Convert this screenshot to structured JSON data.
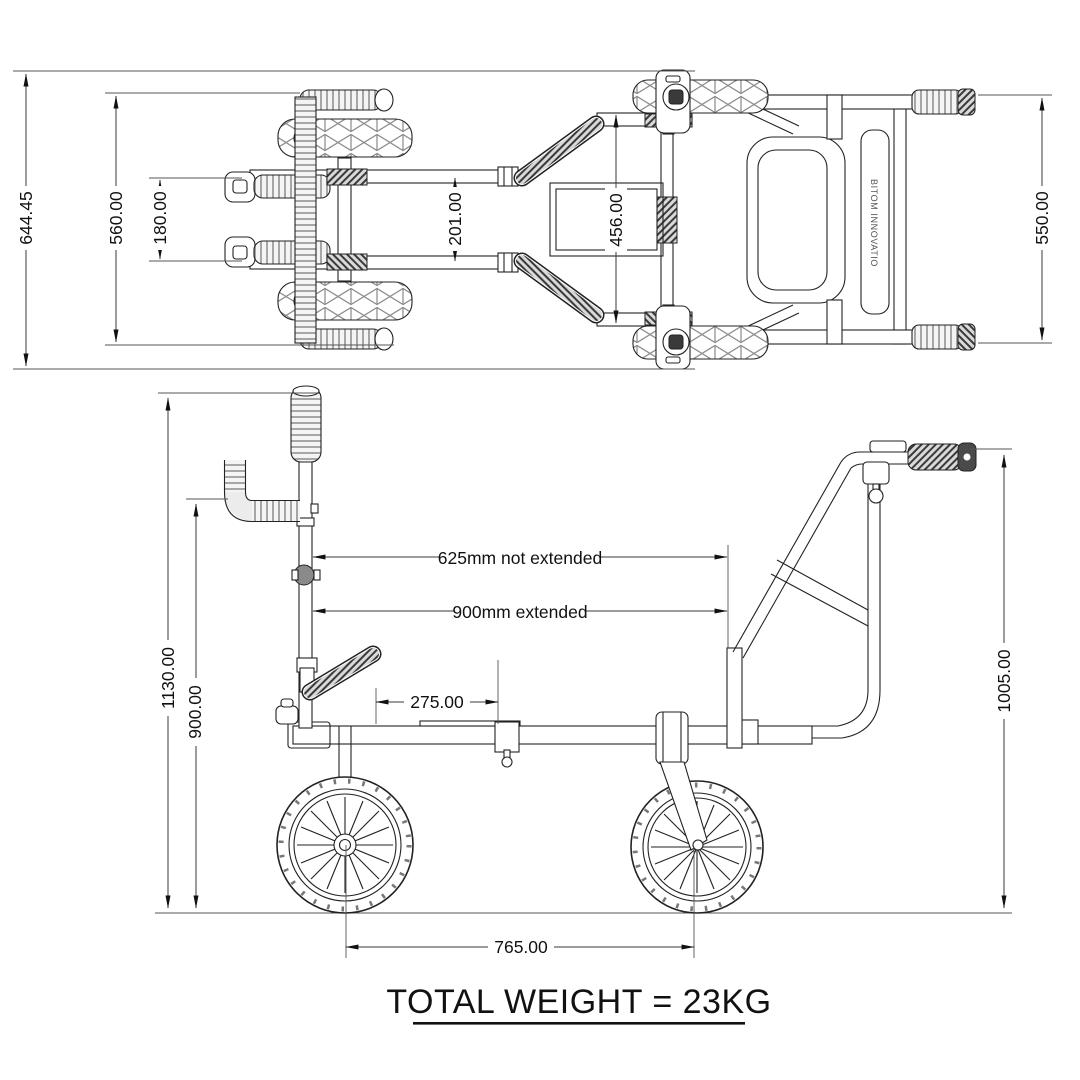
{
  "title": {
    "total_weight": "TOTAL WEIGHT = 23KG"
  },
  "brand": {
    "side_bar_label": "BITOM INNOVATIO"
  },
  "top_view": {
    "dim_overall": "644.45",
    "dim_track": "560.00",
    "dim_grips": "180.00",
    "dim_rails": "201.00",
    "dim_frame": "456.00",
    "dim_body": "550.00"
  },
  "side_view": {
    "dim_overall_height": "1130.00",
    "dim_handle_height": "900.00",
    "dim_pole_retracted": "625mm not extended",
    "dim_pole_extended": "900mm extended",
    "dim_lever": "275.00",
    "dim_wheelbase": "765.00",
    "dim_push_handle_height": "1005.00"
  }
}
